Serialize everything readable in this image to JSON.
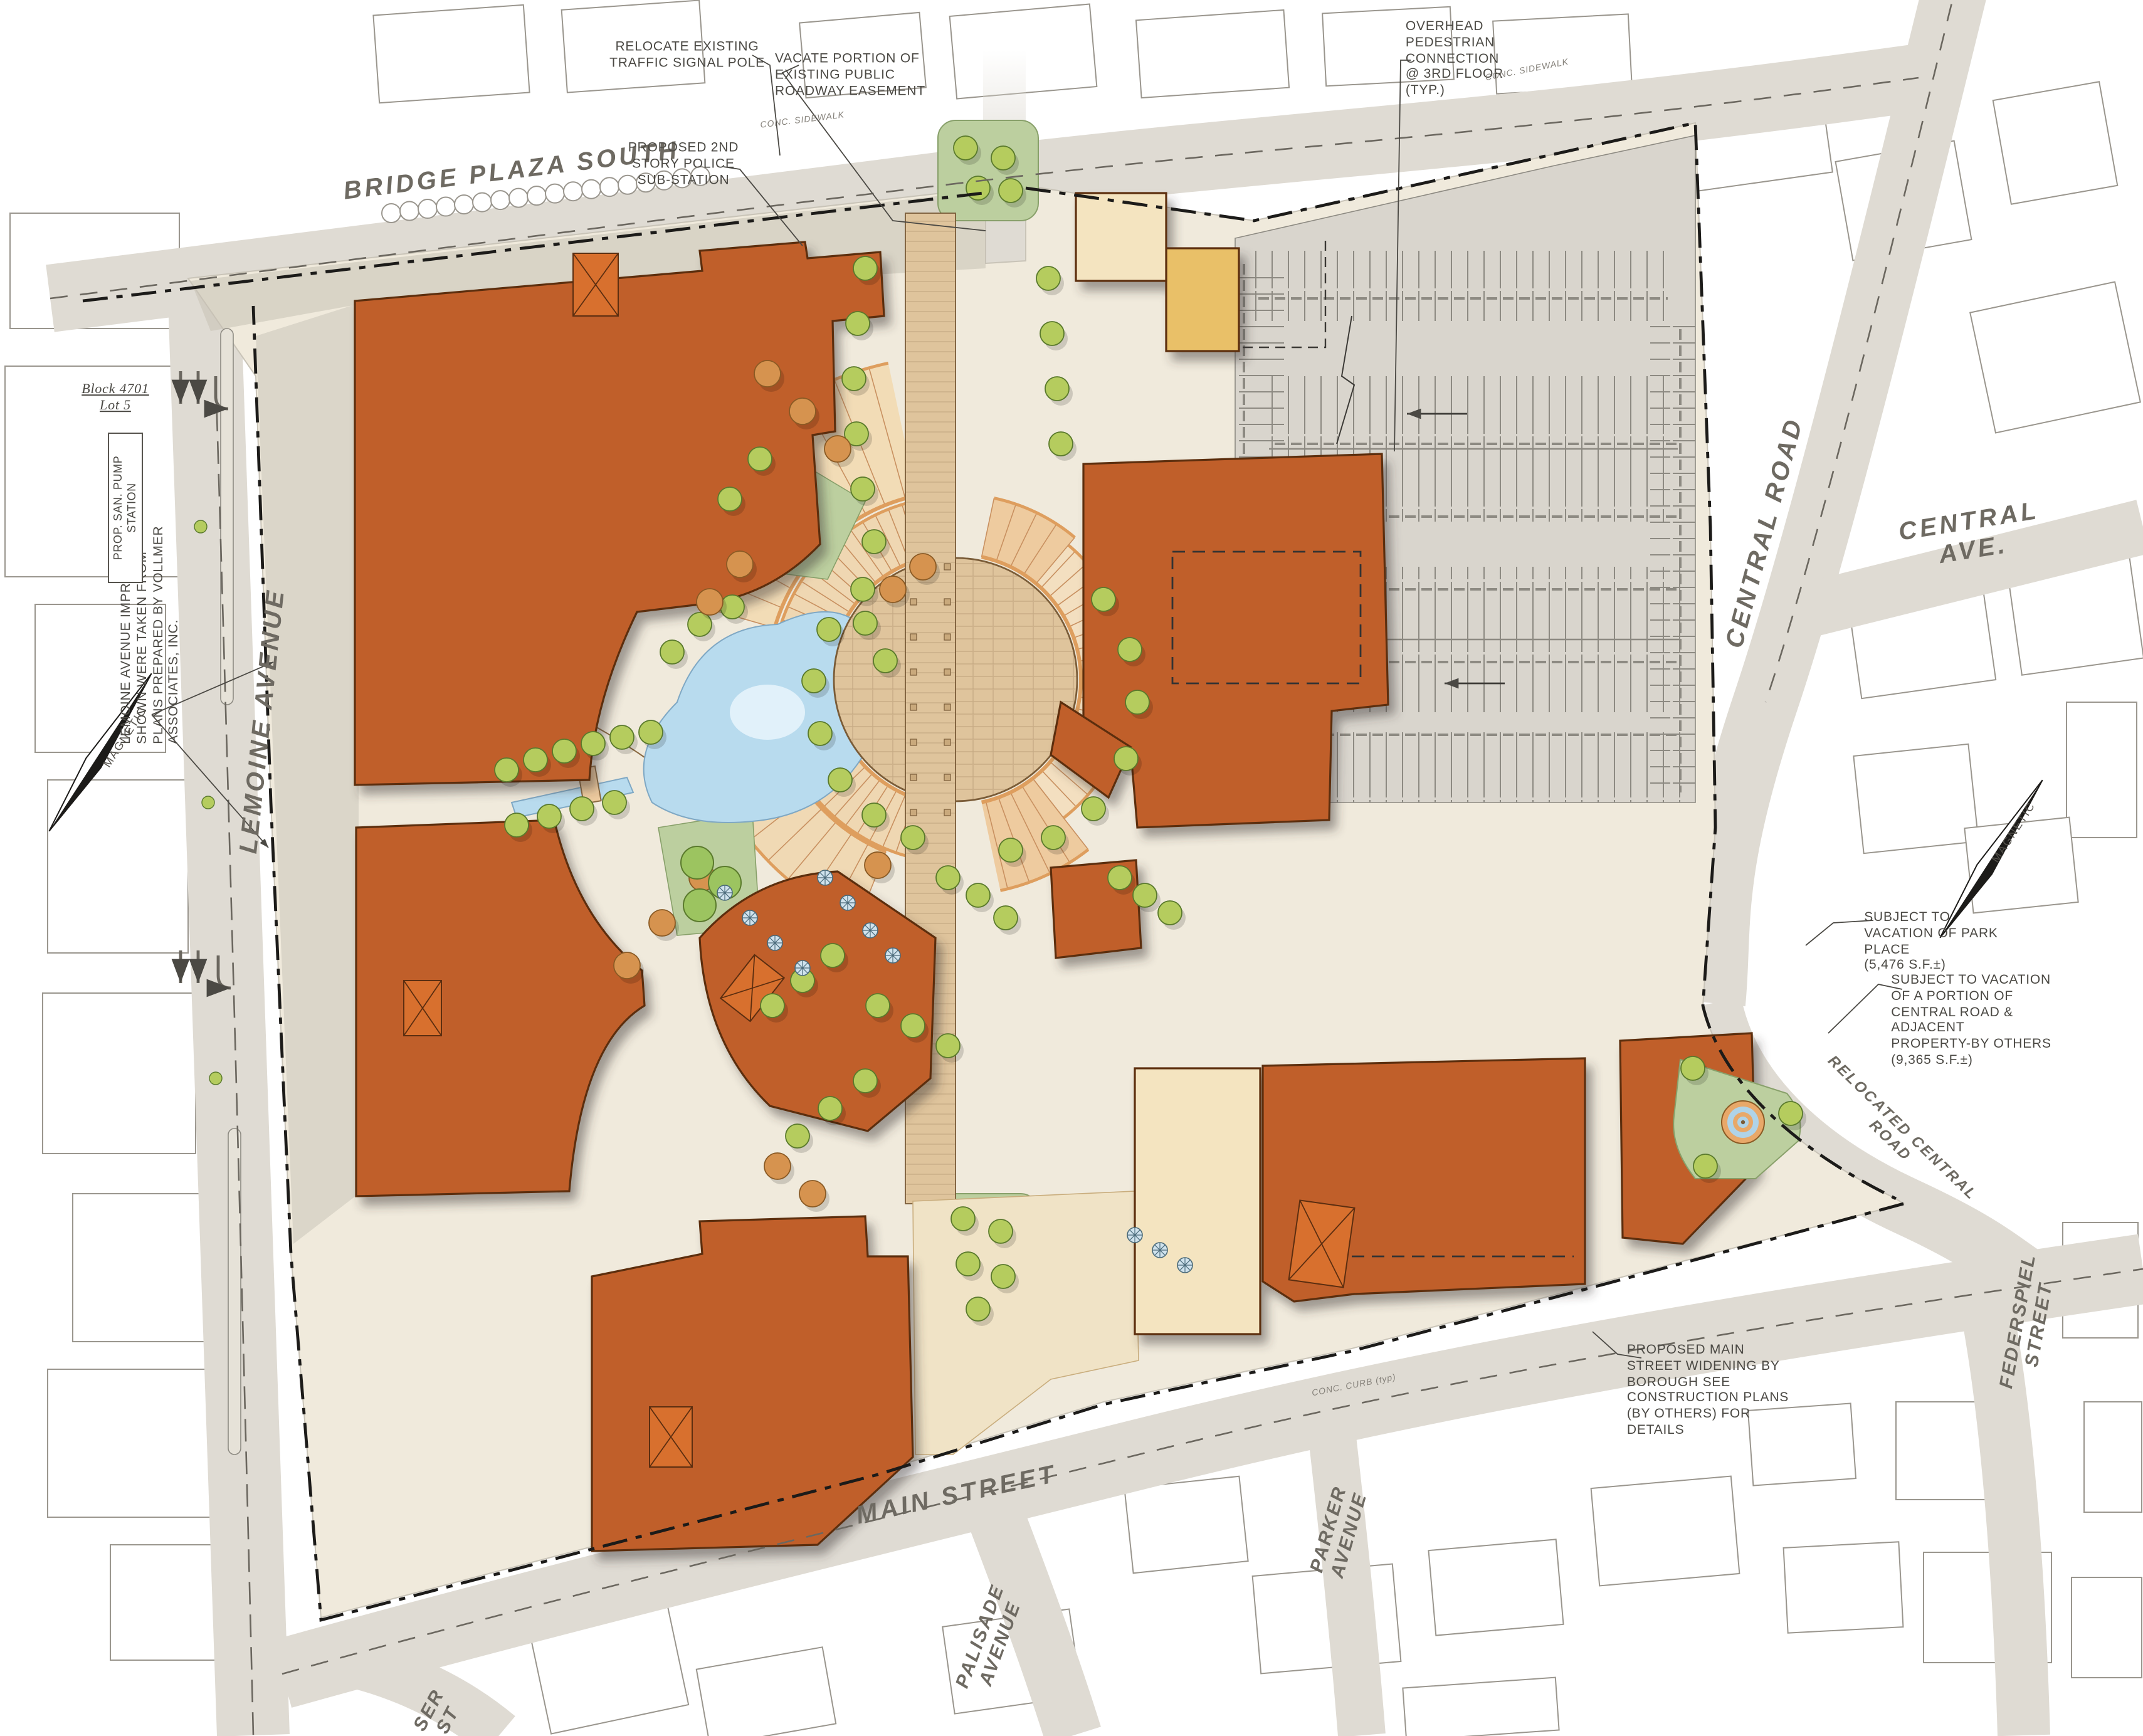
{
  "drawing": {
    "type": "site-plan",
    "district_labels": [
      "Block 4701",
      "Lot 5"
    ]
  },
  "streets": {
    "bridge_plaza_south": "BRIDGE PLAZA SOUTH",
    "lemoine_avenue": "LEMOINE AVENUE",
    "central_road": "CENTRAL ROAD",
    "central_ave": "CENTRAL AVE.",
    "relocated_central_road": "RELOCATED CENTRAL ROAD",
    "federspiel_street": "FEDERSPIEL\nSTREET",
    "main_street": "MAIN STREET",
    "parker_avenue": "PARKER\nAVENUE",
    "palisade_avenue": "PALISADE\nAVENUE",
    "partial_street": "SER\nST"
  },
  "annotations": {
    "relocate_signal": "RELOCATE EXISTING\nTRAFFIC SIGNAL POLE",
    "vacate_easement": "VACATE PORTION OF\nEXISTING PUBLIC\nROADWAY EASEMENT",
    "police_substation": "PROPOSED 2ND\nSTORY POLICE\nSUB-STATION",
    "overhead_pedestrian": "OVERHEAD\nPEDESTRIAN\nCONNECTION\n@ 3RD FLOOR\n(TYP.)",
    "lemoine_improvements": "LEMOINE AVENUE IMPROVEMENTS\nSHOWN WERE TAKEN FROM\nPLANS PREPARED BY VOLLMER\nASSOCIATES, INC.",
    "park_place_vacation": "SUBJECT TO\nVACATION OF PARK\nPLACE\n(5,476 S.F.±)",
    "central_road_vacation": "SUBJECT TO VACATION\nOF A PORTION OF\nCENTRAL ROAD &\nADJACENT\nPROPERTY-BY OTHERS\n(9,365 S.F.±)",
    "main_street_widening": "PROPOSED MAIN\nSTREET WIDENING BY\nBOROUGH SEE\nCONSTRUCTION PLANS\n(BY OTHERS) FOR\nDETAILS",
    "block_lot": "Block 4701\nLot 5",
    "pump_station": "PROP. SAN. PUMP STATION",
    "conc_sidewalk": "CONC. SIDEWALK",
    "conc_curb": "CONC. CURB (typ)",
    "magnetic": "MAGNETIC"
  },
  "colors": {
    "building_orange": "#C05E2B",
    "building_orange_bright": "#D8702E",
    "building_outline": "#5C2E10",
    "building_cream": "#F4E4C0",
    "building_yellow": "#E9C068",
    "road_gray": "#DFDBD3",
    "site_cream": "#F0EADC",
    "parking_gray": "#D9D5CD",
    "paving_tan": "#DFC49C",
    "fan_tan": "#F0D9B4",
    "fan_edge_orange": "#DE9E5E",
    "lawn_green": "#BCCF9F",
    "tree_green": "#B5CC5E",
    "tree_orange": "#D6934F",
    "water_blue": "#B8DBEE",
    "annotation_ink": "#4B4944"
  }
}
